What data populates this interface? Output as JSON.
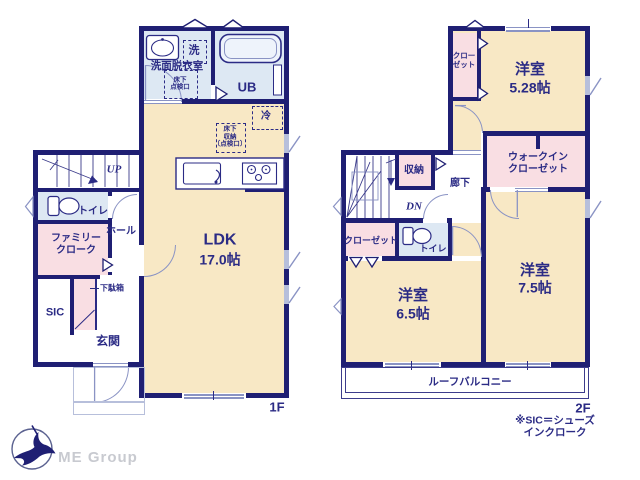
{
  "colors": {
    "wall": "#1f1f73",
    "text_navy": "#2b2b85",
    "room_cream": "#f8e8c5",
    "wet_blue": "#dde8f3",
    "closet_pink": "#f9dee3",
    "fixture_line": "#8a93c4"
  },
  "floor1": {
    "floor_label": "1F",
    "washroom_name": "洗面脱衣室",
    "washer": "洗",
    "underfloor_hatch": "床下\n点検口",
    "bath_name": "UB",
    "ldk_name": "LDK",
    "ldk_size": "17.0帖",
    "fridge": "冷",
    "underfloor_storage": "床下\n収納\n〔点検口〕",
    "stairs_up": "UP",
    "toilet_name": "トイレ",
    "hall_name": "ホール",
    "family_cloak_name": "ファミリー\nクローク",
    "shoe_cabinet_name": "下駄箱",
    "sic_name": "SIC",
    "entrance_name": "玄関"
  },
  "floor2": {
    "floor_label": "2F",
    "room_528_name": "洋室",
    "room_528_size": "5.28帖",
    "closet_528_name": "クロー\nゼット",
    "storage_name": "収納",
    "corridor_name": "廊下",
    "stairs_down": "DN",
    "wic_name": "ウォークイン\nクローゼット",
    "closet_65_name": "クローゼット",
    "toilet_name": "トイレ",
    "room_65_name": "洋室",
    "room_65_size": "6.5帖",
    "room_75_name": "洋室",
    "room_75_size": "7.5帖",
    "balcony_name": "ルーフバルコニー"
  },
  "footnote": "※SIC＝シューズインクローク",
  "logo_text": "ME Group"
}
